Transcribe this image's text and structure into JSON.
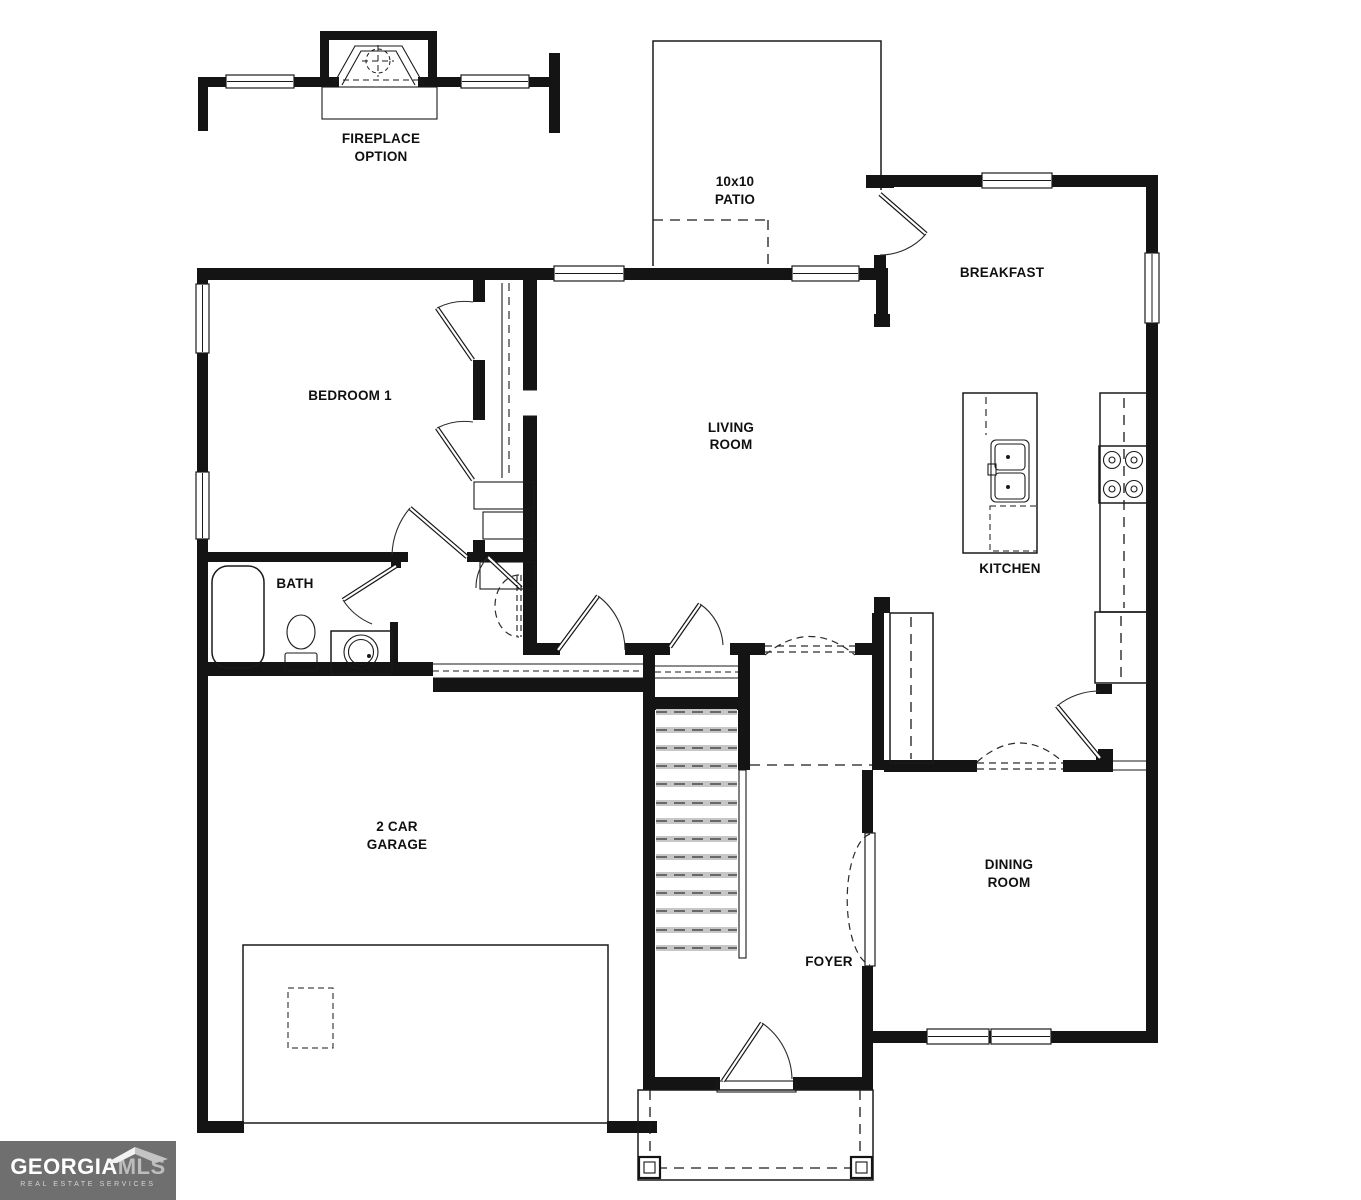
{
  "page": {
    "background": "#ffffff"
  },
  "colors": {
    "ink": "#141414",
    "logo_bg": "#6f6f6f",
    "logo_primary": "#ffffff",
    "logo_secondary": "#bdbdbd",
    "logo_tagline": "#d4d4d4"
  },
  "plan": {
    "fireplace_note": {
      "line1": "FIREPLACE",
      "line2": "OPTION"
    },
    "patio": {
      "size": "10x10",
      "name": "PATIO"
    },
    "rooms": {
      "breakfast": "BREAKFAST",
      "bedroom1": "BEDROOM 1",
      "living_line1": "LIVING",
      "living_line2": "ROOM",
      "kitchen": "KITCHEN",
      "bath": "BATH",
      "garage_line1": "2 CAR",
      "garage_line2": "GARAGE",
      "foyer": "FOYER",
      "dining_line1": "DINING",
      "dining_line2": "ROOM"
    }
  },
  "logo": {
    "brand": "GEORGIA",
    "brand_suffix": "MLS",
    "tagline": "REAL ESTATE SERVICES"
  }
}
